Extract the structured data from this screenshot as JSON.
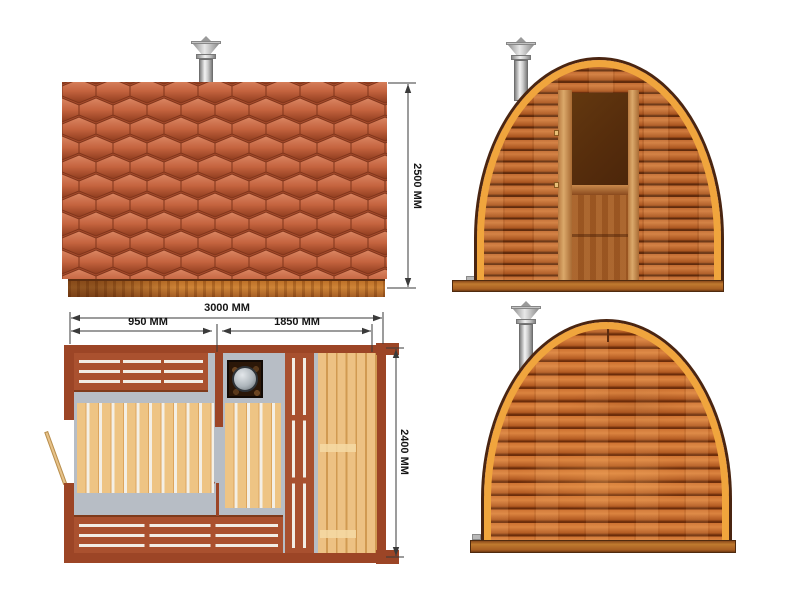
{
  "drawing": {
    "subject": "arched-cabin-sauna-technical-drawing",
    "views": [
      "side-elevation",
      "front-elevation",
      "floor-plan",
      "rear-elevation"
    ]
  },
  "dimensions": {
    "side_height": "2500 MM",
    "plan_width_total": "3000 MM",
    "plan_width_left": "950 MM",
    "plan_width_right": "1850 MM",
    "plan_depth": "2400 MM"
  },
  "colors": {
    "shingle_tile": "#c4633e",
    "wall_plank_wood": "#b96329",
    "arch_trim": "#f0a53d",
    "arch_outline": "#4a2511",
    "plan_wall_red": "#9c4526",
    "plan_bench_red": "#aa512f",
    "plan_floor_gray": "#b7bdc5",
    "plan_deck_tan": "#eec484",
    "chimney_metal": "#c9c9c9",
    "dimension_line": "#3a3a3a"
  },
  "icons": {
    "chimney": "chimney-icon",
    "stove": "stove-icon"
  }
}
